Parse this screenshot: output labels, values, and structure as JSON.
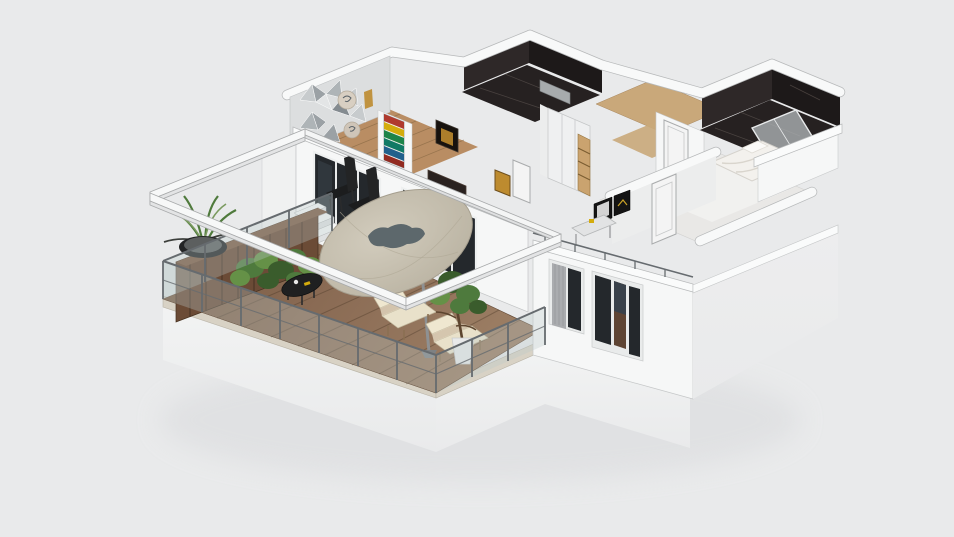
{
  "scene": {
    "type": "3d-floorplan-isometric-render",
    "description": "Overhead cutaway 3D render of an apartment with a large wooden terrace, pergola, patio umbrella and interior rooms, on a plain light-gray canvas. No text or UI chrome is visible.",
    "rooms": [
      {
        "name": "living-room",
        "floor": "light oak wood",
        "features": [
          "gray triangle mosaic accent wall",
          "colorful chevron artwork",
          "black dining chairs",
          "dark sliding glass doors"
        ]
      },
      {
        "name": "hallway-closet",
        "floor": "oak wood",
        "features": [
          "white wardrobe with wooden shelves",
          "white interior doors",
          "gold artwork"
        ]
      },
      {
        "name": "bathroom-center",
        "floor": "black marble",
        "features": [
          "gray vanity counter",
          "dark marble walls"
        ]
      },
      {
        "name": "bathroom-northeast",
        "floor": "black marble",
        "features": [
          "glass shower enclosure",
          "dark marble walls"
        ]
      },
      {
        "name": "bedroom",
        "floor": "pale glossy screed",
        "features": [
          "white unmade bed",
          "white door",
          "desk with black picture frames",
          "window wall with gray curtains"
        ]
      },
      {
        "name": "balcony-terrace",
        "floor": "brown hardwood decking",
        "features": [
          "white pergola beams",
          "beige patio umbrella",
          "two beige lounge chairs",
          "round black coffee table",
          "wooden planter with green hedge",
          "black bowl grass planter",
          "potted tree in white pot",
          "glass railing with metal posts",
          "white outdoor stairs"
        ]
      }
    ],
    "objects": [
      "pergola",
      "patio-umbrella",
      "lounge-chair",
      "lounge-chair",
      "coffee-table",
      "planter-box",
      "hedge-plants",
      "potted-grass-plant",
      "potted-tree",
      "glass-railing",
      "outdoor-stairs",
      "dining-chair",
      "dining-chair",
      "sideboard",
      "sliding-glass-doors",
      "wardrobe",
      "bed",
      "interior-doors",
      "windows",
      "curtains",
      "shower-enclosure",
      "vanity-counter",
      "desk",
      "picture-frames",
      "accent-wall-mosaic",
      "artwork-chevron",
      "artwork-gold"
    ]
  },
  "palette": {
    "background": "#e9eaeb",
    "ground_shadow": "#dcdddf",
    "wall_white": "#f6f7f7",
    "wall_top": "#fafbfb",
    "wall_edge": "#b7b9ba",
    "wall_shade": "#eceded",
    "plinth": "#f0f1f1",
    "facade": "#f2f3f3",
    "deck_wood": "#8a6b54",
    "deck_plank_line": "#5e4430",
    "stone_edge": "#d8d2c5",
    "planter_wood": "#6b4b36",
    "planter_wood_dark": "#503828",
    "hedge_green_1": "#4e7a3d",
    "hedge_green_2": "#659147",
    "hedge_green_3": "#3a5c2c",
    "leaf_green": "#4f7a3c",
    "twig": "#3c3f3b",
    "umbrella_canopy": "#c7c0b0",
    "umbrella_rim": "#a59e8e",
    "umbrella_motif": "#5d686c",
    "umbrella_pole": "#8e9193",
    "lounge_seat": "#e9e1ca",
    "lounge_back": "#efe7d0",
    "lounge_frame": "#8a6f52",
    "coffee_table": "#1f2021",
    "pot_white": "#e8e9e9",
    "railing_metal": "#666b6f",
    "railing_glass": "rgba(188,203,203,0.32)",
    "marble_dark": "#262121",
    "marble_vein": "#5a524e",
    "marble_wall_dark": "#2e2828",
    "marble_wall_darker": "#1d1919",
    "wood_floor_hall": "#c9a87a",
    "wood_floor_living": "#b98d63",
    "plank_line": "#8a6a45",
    "glass_dark": "#24282c",
    "glass_reflection": "#39414a",
    "mullion": "#e9ebeb",
    "curtain": "#aaacaf",
    "bed_white": "#f3f1ed",
    "bed_shadow": "#d9d5cd",
    "bedroom_floor": "#e9e8e6",
    "door_white": "#f4f4f4",
    "door_edge": "#a9abac",
    "shower_glass": "rgba(175,181,183,0.78)",
    "wardrobe_white": "#eff0f1",
    "shelf_wood": "#caa36f",
    "sideboard_dark": "#2a2220",
    "art_gold": "#bd8b2f",
    "art_frame_dark": "#17120e",
    "chevron_1": "#b03a2e",
    "chevron_2": "#d4ac0d",
    "chevron_3": "#1e8449",
    "chevron_4": "#117a65",
    "chevron_5": "#21618c",
    "chevron_6": "#922b21",
    "mosaic_a": "#c7cbcd",
    "mosaic_b": "#9ba1a5",
    "mosaic_c": "#e3e5e6",
    "mosaic_d": "#848b90",
    "mosaic_e": "#aeb4b7",
    "chair_black": "#1c1d1e",
    "frame_black": "#141414",
    "desk_top": "#e2e3e4",
    "sink_gray": "#a7abad"
  }
}
